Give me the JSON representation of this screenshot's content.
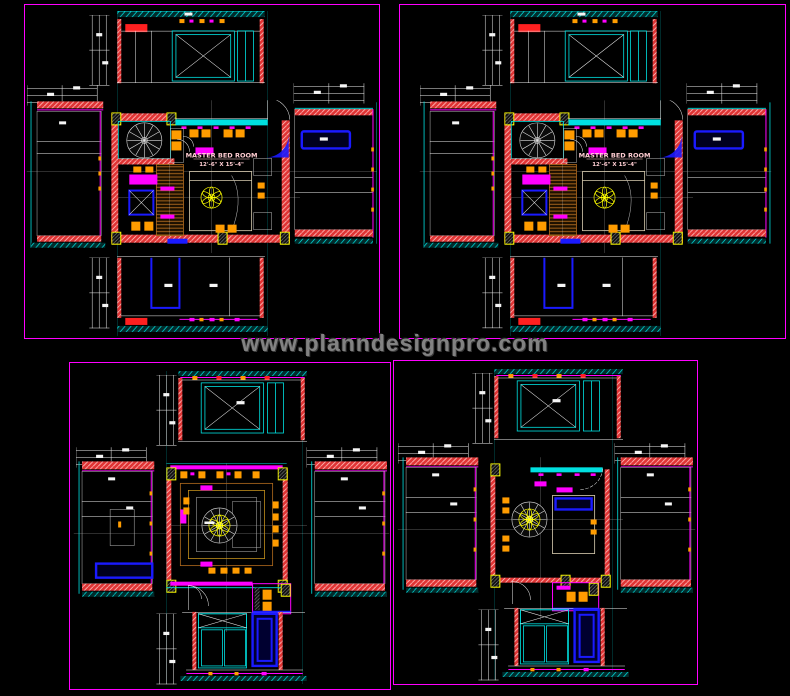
{
  "watermark": "www.planndesignpro.com",
  "sheets": [
    {
      "id": "top-left",
      "room_label": "MASTER BED ROOM",
      "room_size": "12'-6\" X 15'-4\""
    },
    {
      "id": "top-right",
      "room_label": "MASTER BED ROOM",
      "room_size": "12'-6\" X 15'-4\""
    },
    {
      "id": "bottom-left"
    },
    {
      "id": "bottom-right"
    }
  ],
  "colors": {
    "background": "#000000",
    "frame": "#ff00ff",
    "wall": "#e03434",
    "glass": "#00e0e0",
    "dims": "#efefef",
    "furniture": "#ff00ff",
    "wood": "#b06a1e",
    "lights": "#ff9c00",
    "blue": "#1a1aff",
    "highlight": "#ffff00",
    "reddetail": "#ff2020",
    "label": "#ffcdd2",
    "watermark": "#828282"
  }
}
